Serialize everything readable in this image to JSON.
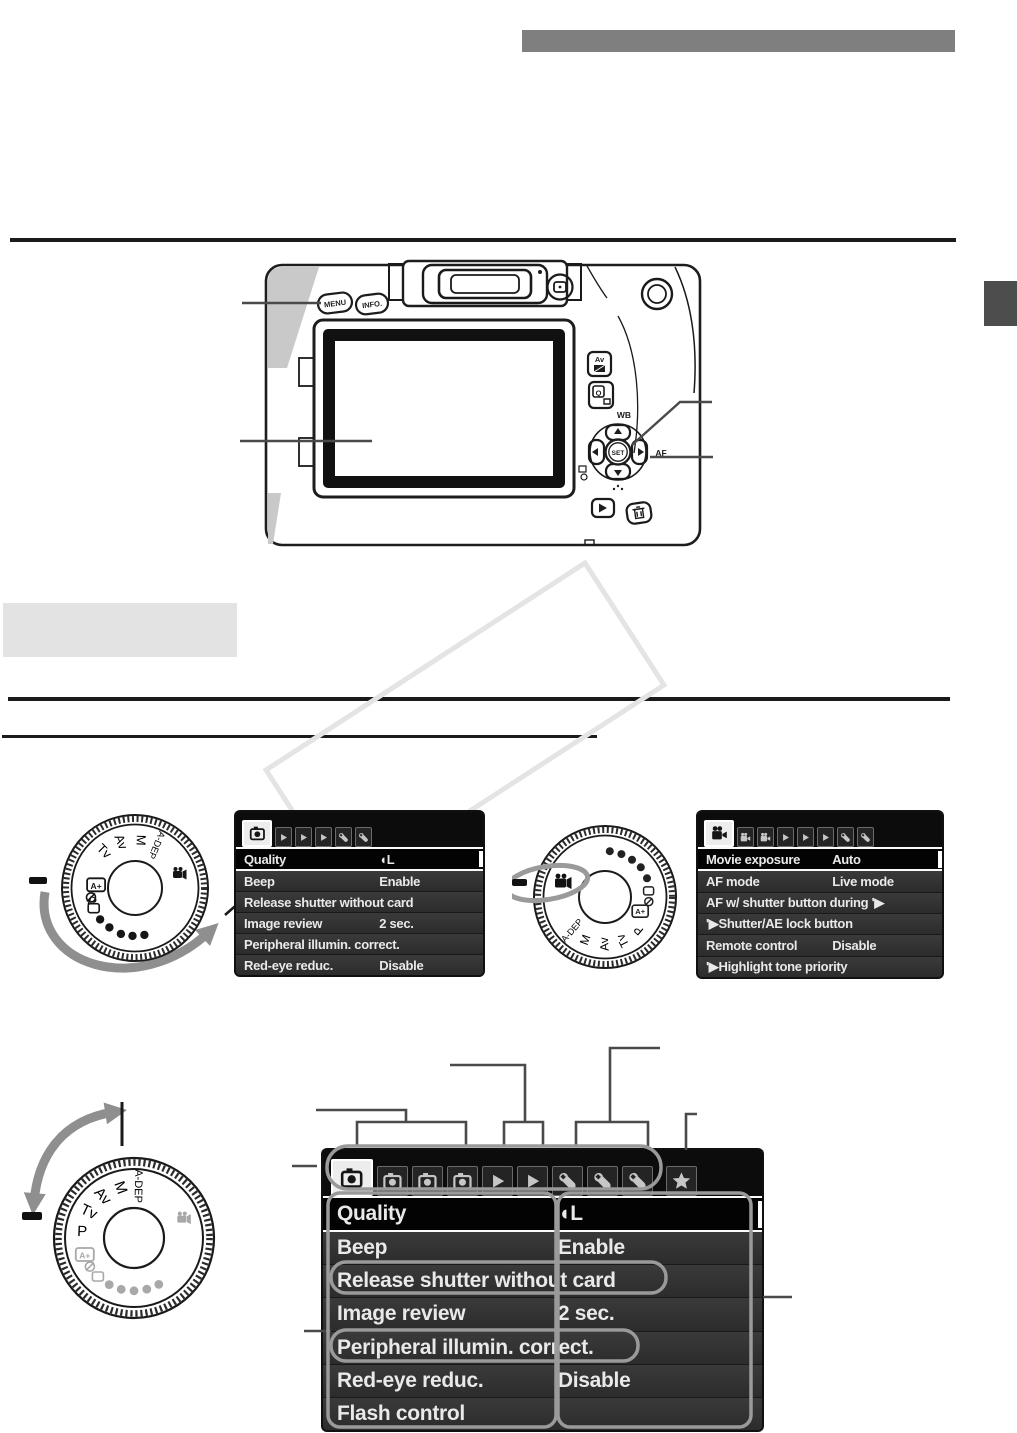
{
  "decor": {
    "title_bar_color": "#7f7f7f",
    "chapter_tab_color": "#4d4d4d",
    "gray_box_color": "#e3e3e3",
    "callout_color": "#4a4a4a",
    "highlight_outline_color": "#9a9a9a",
    "arrow_color": "#8f8f8f",
    "watermark_color": "#e4e4e4"
  },
  "camera": {
    "labels": {
      "menu": "MENU",
      "info": "INFO.",
      "av": "Av",
      "q": "Q",
      "wb": "WB",
      "set": "SET",
      "af": "AF"
    }
  },
  "dials": {
    "labels": [
      "P",
      "Tv",
      "Av",
      "M",
      "A-DEP"
    ],
    "auto_label": "A+"
  },
  "menu_a": {
    "tabs": [
      {
        "icon": "camera",
        "selected": true
      },
      {
        "icon": "playback"
      },
      {
        "icon": "playback"
      },
      {
        "icon": "playback"
      },
      {
        "icon": "wrench"
      },
      {
        "icon": "wrench"
      }
    ],
    "rows": [
      {
        "label": "Quality",
        "value": "◖L",
        "selected": true
      },
      {
        "label": "Beep",
        "value": "Enable"
      },
      {
        "label": "Release shutter without card",
        "value": ""
      },
      {
        "label": "Image review",
        "value": "2 sec."
      },
      {
        "label": "Peripheral illumin. correct.",
        "value": ""
      },
      {
        "label": "Red-eye reduc.",
        "value": "Disable"
      }
    ]
  },
  "menu_b": {
    "tabs": [
      {
        "icon": "movie",
        "selected": true
      },
      {
        "icon": "movie"
      },
      {
        "icon": "movie"
      },
      {
        "icon": "playback"
      },
      {
        "icon": "playback"
      },
      {
        "icon": "playback"
      },
      {
        "icon": "wrench"
      },
      {
        "icon": "wrench"
      }
    ],
    "rows": [
      {
        "label": "Movie exposure",
        "value": "Auto",
        "selected": true
      },
      {
        "label": "AF mode",
        "value": "Live mode"
      },
      {
        "label": "AF w/ shutter button during '▶",
        "value": ""
      },
      {
        "label": "'▶Shutter/AE lock button",
        "value": ""
      },
      {
        "label": "Remote control",
        "value": "Disable"
      },
      {
        "label": "'▶Highlight tone priority",
        "value": ""
      }
    ]
  },
  "menu_c": {
    "tabs": [
      {
        "icon": "camera",
        "selected": true
      },
      {
        "icon": "camera"
      },
      {
        "icon": "camera"
      },
      {
        "icon": "camera"
      },
      {
        "icon": "playback"
      },
      {
        "icon": "playback"
      },
      {
        "icon": "wrench"
      },
      {
        "icon": "wrench"
      },
      {
        "icon": "wrench"
      },
      {
        "icon": "star",
        "star": true
      }
    ],
    "rows": [
      {
        "label": "Quality",
        "value": "◖L",
        "selected": true
      },
      {
        "label": "Beep",
        "value": "Enable"
      },
      {
        "label": "Release shutter without card",
        "value": ""
      },
      {
        "label": "Image review",
        "value": "2 sec."
      },
      {
        "label": "Peripheral illumin. correct.",
        "value": ""
      },
      {
        "label": "Red-eye reduc.",
        "value": "Disable"
      },
      {
        "label": "Flash control",
        "value": ""
      }
    ]
  }
}
